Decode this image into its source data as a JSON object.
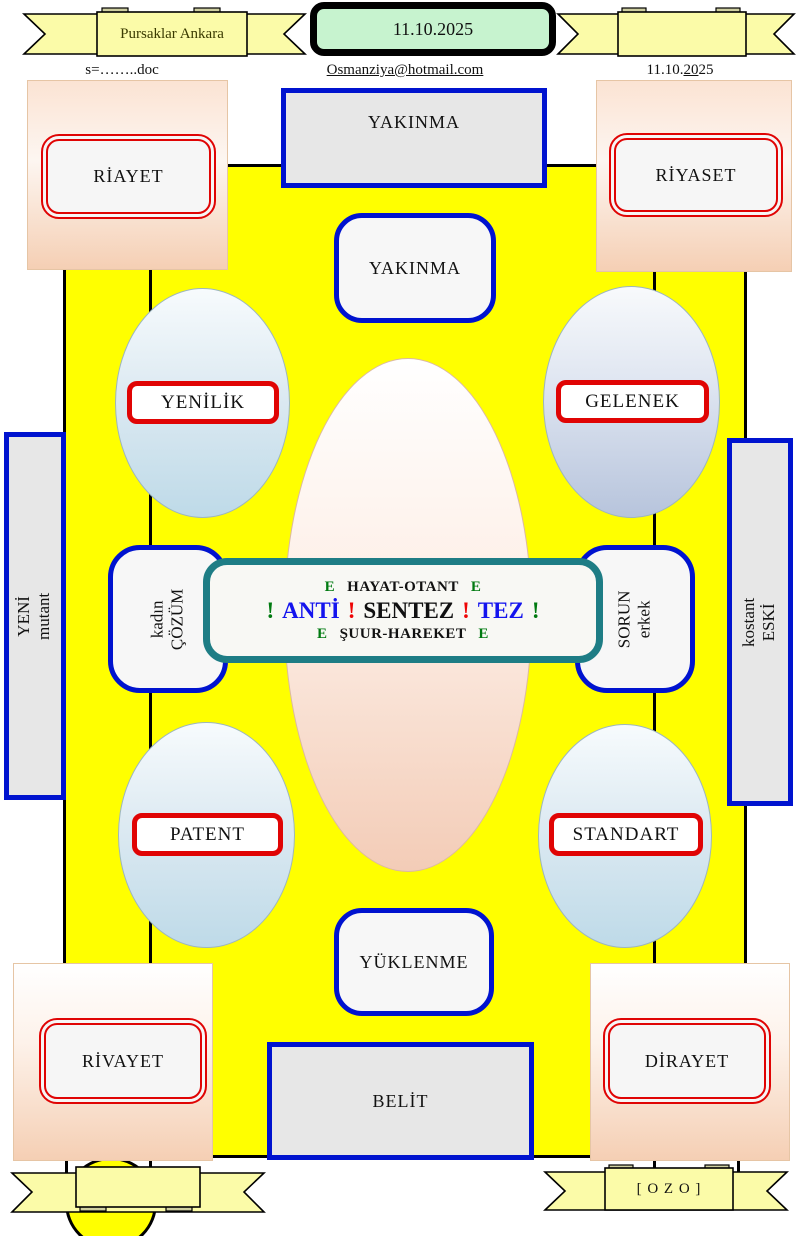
{
  "header": {
    "left_ribbon_label": "Pursaklar Ankara",
    "date_badge": "11.10.2025",
    "doc_name": "s=……..doc",
    "email": "Osmanziya@hotmail.com",
    "date_right": {
      "pre": "11.10.",
      "underlined": "20",
      "post": "25"
    }
  },
  "diagram": {
    "top_outer_label": "YAKINMA",
    "top_inner_label": "YAKINMA",
    "corner_top_left": "RİAYET",
    "corner_top_right": "RİYASET",
    "corner_bottom_left": "RİVAYET",
    "corner_bottom_right": "DİRAYET",
    "ellipse_top_left": "YENİLİK",
    "ellipse_top_right": "GELENEK",
    "ellipse_bottom_left": "PATENT",
    "ellipse_bottom_right": "STANDART",
    "side_left_outer": {
      "line1": "YENİ",
      "line2": "mutant"
    },
    "side_left_inner": {
      "line1": "kadın",
      "line2": "ÇÖZÜM"
    },
    "side_right_inner": {
      "line1": "SORUN",
      "line2": "erkek"
    },
    "side_right_outer": {
      "line1": "kostant",
      "line2": "ESKİ"
    },
    "center": {
      "line1": {
        "e1": "E",
        "main": "HAYAT-OTANT",
        "e2": "E"
      },
      "line2": {
        "x1": "!",
        "anti": "ANTİ",
        "x2": "!",
        "sentez": "SENTEZ",
        "x3": "!",
        "tez": "TEZ",
        "x4": "!"
      },
      "line3": {
        "e1": "E",
        "main": "ŞUUR-HAREKET",
        "e2": "E"
      }
    },
    "bottom_inner_label": "YÜKLENME",
    "bottom_outer_label": "BELİT"
  },
  "footer": {
    "right_ribbon_label": "[ O Z O ]"
  },
  "colors": {
    "canvas_yellow": "#ffff00",
    "shape_blue_border": "#0013cf",
    "shape_red_border": "#e00404",
    "teal_border": "#1e7d85",
    "date_badge_green": "#c7f3cf",
    "ribbon_yellow": "#fbfba8",
    "peach_fill": "#f5cfb4",
    "blue_ellipse_fill": "#bedae8",
    "text_green": "#007a10",
    "text_blue": "#1414ee",
    "text_red": "#ee0505"
  }
}
